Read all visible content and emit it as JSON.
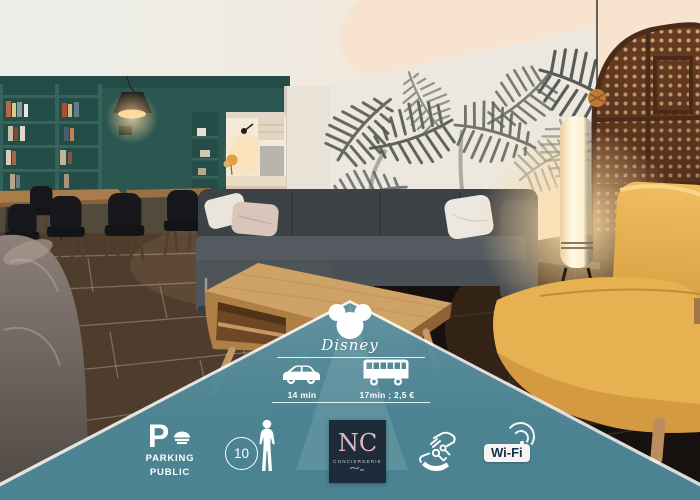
{
  "image_type": "apartment listing photo with amenity info overlay",
  "overlay": {
    "disney_label": "Disney",
    "transport": [
      {
        "icon": "car-icon",
        "label": "14 min"
      },
      {
        "icon": "bus-icon",
        "label": "17min ; 2,5 €"
      }
    ],
    "amenities": {
      "parking": {
        "letter": "P",
        "line1": "PARKING",
        "line2": "PUBLIC"
      },
      "capacity": {
        "value": "10"
      },
      "brand": {
        "initials": "NC",
        "subtitle": "CONCIERGERIE"
      },
      "wifi": {
        "label": "Wi-Fi"
      }
    },
    "colors": {
      "overlay_teal": "#387688",
      "edge_white": "#ffffff",
      "brand_box_navy": "#1d2b3b",
      "brand_initials_pink": "#ddb8bd",
      "wifi_text_navy": "#15304a"
    }
  },
  "photo": {
    "scene": "open-plan living room: teal bookshelf wall and dining set on left, kitchen opening, palm-leaf mural wall, grey corner sofa with cushions, glowing floor lamp, carved wooden screen and yellow lounge sofa on right, wooden coffee table on dark tiled floor",
    "colors": {
      "teal_wall": "#2c5751",
      "mural_wall": "#ece8df",
      "sofa_grey": "#474c51",
      "sofa_yellow": "#e4ac4c",
      "wood_screen": "#6b3e26",
      "floor_dark": "#16110e",
      "coffee_table_wood": "#cfa267"
    }
  }
}
